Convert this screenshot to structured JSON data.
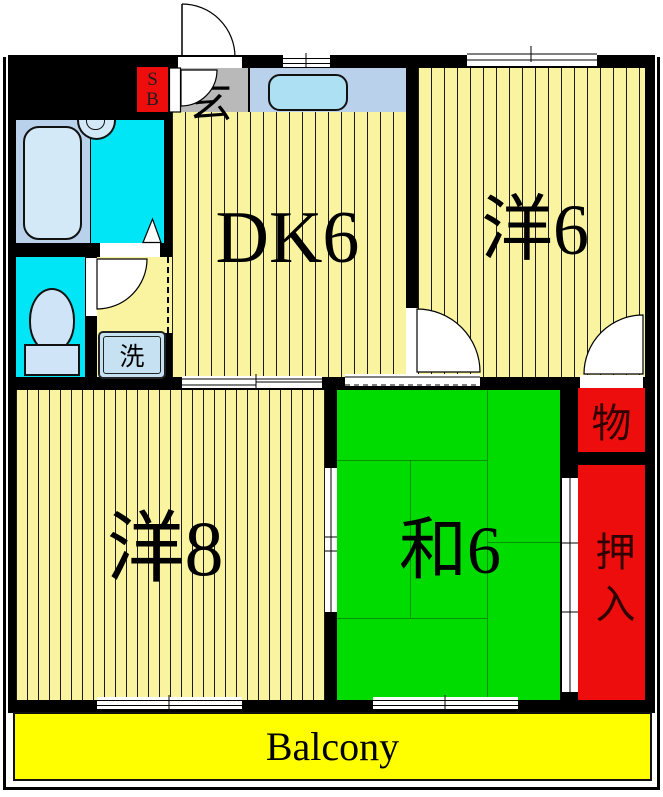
{
  "plan": {
    "type": "apartment-floorplan",
    "rooms": {
      "dining_kitchen": {
        "label": "DK6"
      },
      "western6": {
        "label": "洋6"
      },
      "western8": {
        "label": "洋8"
      },
      "japanese6": {
        "label": "和6"
      },
      "storage": {
        "label": "物"
      },
      "closet": {
        "label": "押入"
      },
      "entrance": {
        "label": "玄"
      },
      "shoe_box": {
        "line1": "S",
        "line2": "B"
      },
      "washer": {
        "label": "洗"
      },
      "balcony": {
        "label": "Balcony"
      }
    },
    "colors": {
      "flooring_yellow": "#FAF4A1",
      "balcony_yellow": "#FFFF00",
      "tatami_green": "#00DB00",
      "closet_red": "#EE0D0D",
      "wet_area_cyan": "#00E6F6",
      "fixture_blue": "#D3E9F8",
      "counter_blue": "#B9D1EA",
      "sink_blue": "#ADE0F3",
      "entrance_gray": "#B9B9B9",
      "wall_black": "#000000"
    }
  }
}
